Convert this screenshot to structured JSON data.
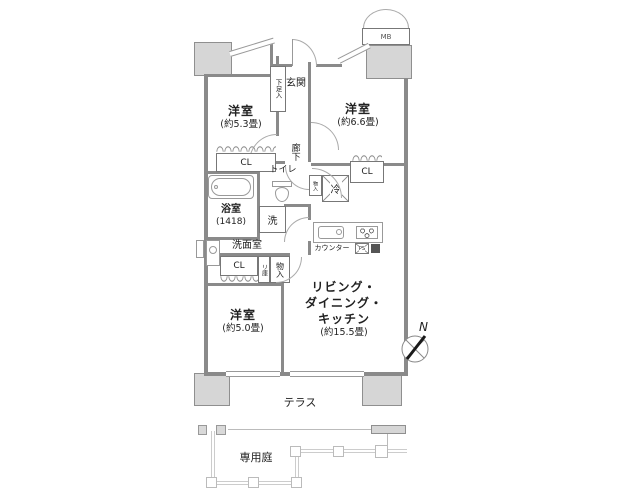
{
  "plan": {
    "rooms": {
      "bedroom1": {
        "name": "洋室",
        "size": "(約5.3畳)"
      },
      "bedroom2": {
        "name": "洋室",
        "size": "(約6.6畳)"
      },
      "bedroom3": {
        "name": "洋室",
        "size": "(約5.0畳)"
      },
      "ldk": {
        "name": "リビング・\nダイニング・\nキッチン",
        "size": "(約15.5畳)"
      },
      "entrance": "玄関",
      "hallway": "廊下",
      "toilet": "トイレ",
      "bathroom": {
        "name": "浴室",
        "size": "(1418)"
      },
      "washroom": "洗面室"
    },
    "fixtures": {
      "shoe_cabinet": "下足入",
      "closet": "CL",
      "storage": "物入",
      "linen": "リ庫",
      "washer": "洗",
      "fridge": "冷",
      "counter_label": "カウンター",
      "pipe_space": "PS",
      "meter_box": "MB"
    },
    "outdoor": {
      "terrace": "テラス",
      "garden": "専用庭"
    },
    "compass": {
      "north": "N"
    },
    "colors": {
      "wall": "#8a8a8a",
      "pillar": "#d6d6d6",
      "fence": "#cccccc",
      "door_arc": "#aaaaaa",
      "text": "#222222"
    }
  }
}
